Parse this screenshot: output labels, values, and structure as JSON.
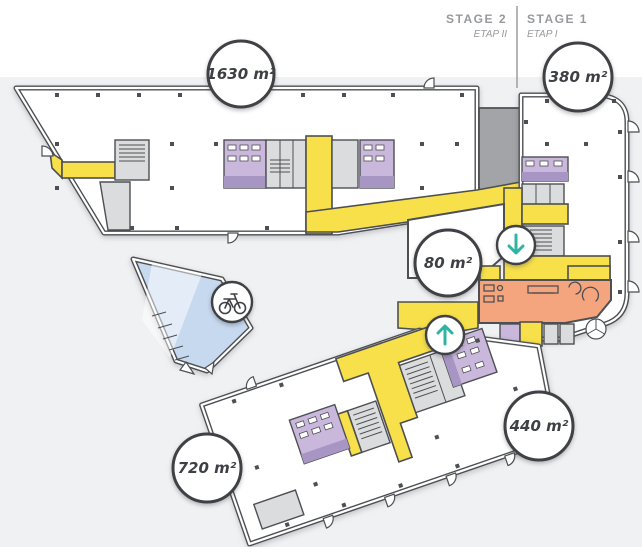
{
  "stages": {
    "stage2": {
      "label": "STAGE 2",
      "sublabel": "ETAP II"
    },
    "stage1": {
      "label": "STAGE 1",
      "sublabel": "ETAP I"
    }
  },
  "area_badges": {
    "stage2_main": "1630 m²",
    "stage1_main": "380 m²",
    "core_mid": "80 m²",
    "lower_main": "720 m²",
    "lower_right": "440 m²"
  },
  "icons": {
    "bicycle": "bicycle-icon",
    "arrow_down": "arrow-down-icon",
    "arrow_up": "arrow-up-icon",
    "revolving_door": "revolving-door-icon"
  },
  "colors": {
    "background": "#F0F1F3",
    "top_band": "#FFFFFF",
    "wall": "#4D4F53",
    "corridor_yellow": "#F8E04A",
    "room_purple": "#C9B8DC",
    "room_purple_dark": "#A795C3",
    "core_gray": "#DBDCDD",
    "stage_gap_gray": "#A2A4A7",
    "lobby_orange": "#F4A57E",
    "ramp_blue": "#C6D9EF",
    "arrow_teal": "#2FB3A3",
    "label_gray": "#97999C",
    "badge_text": "#3E4045"
  }
}
